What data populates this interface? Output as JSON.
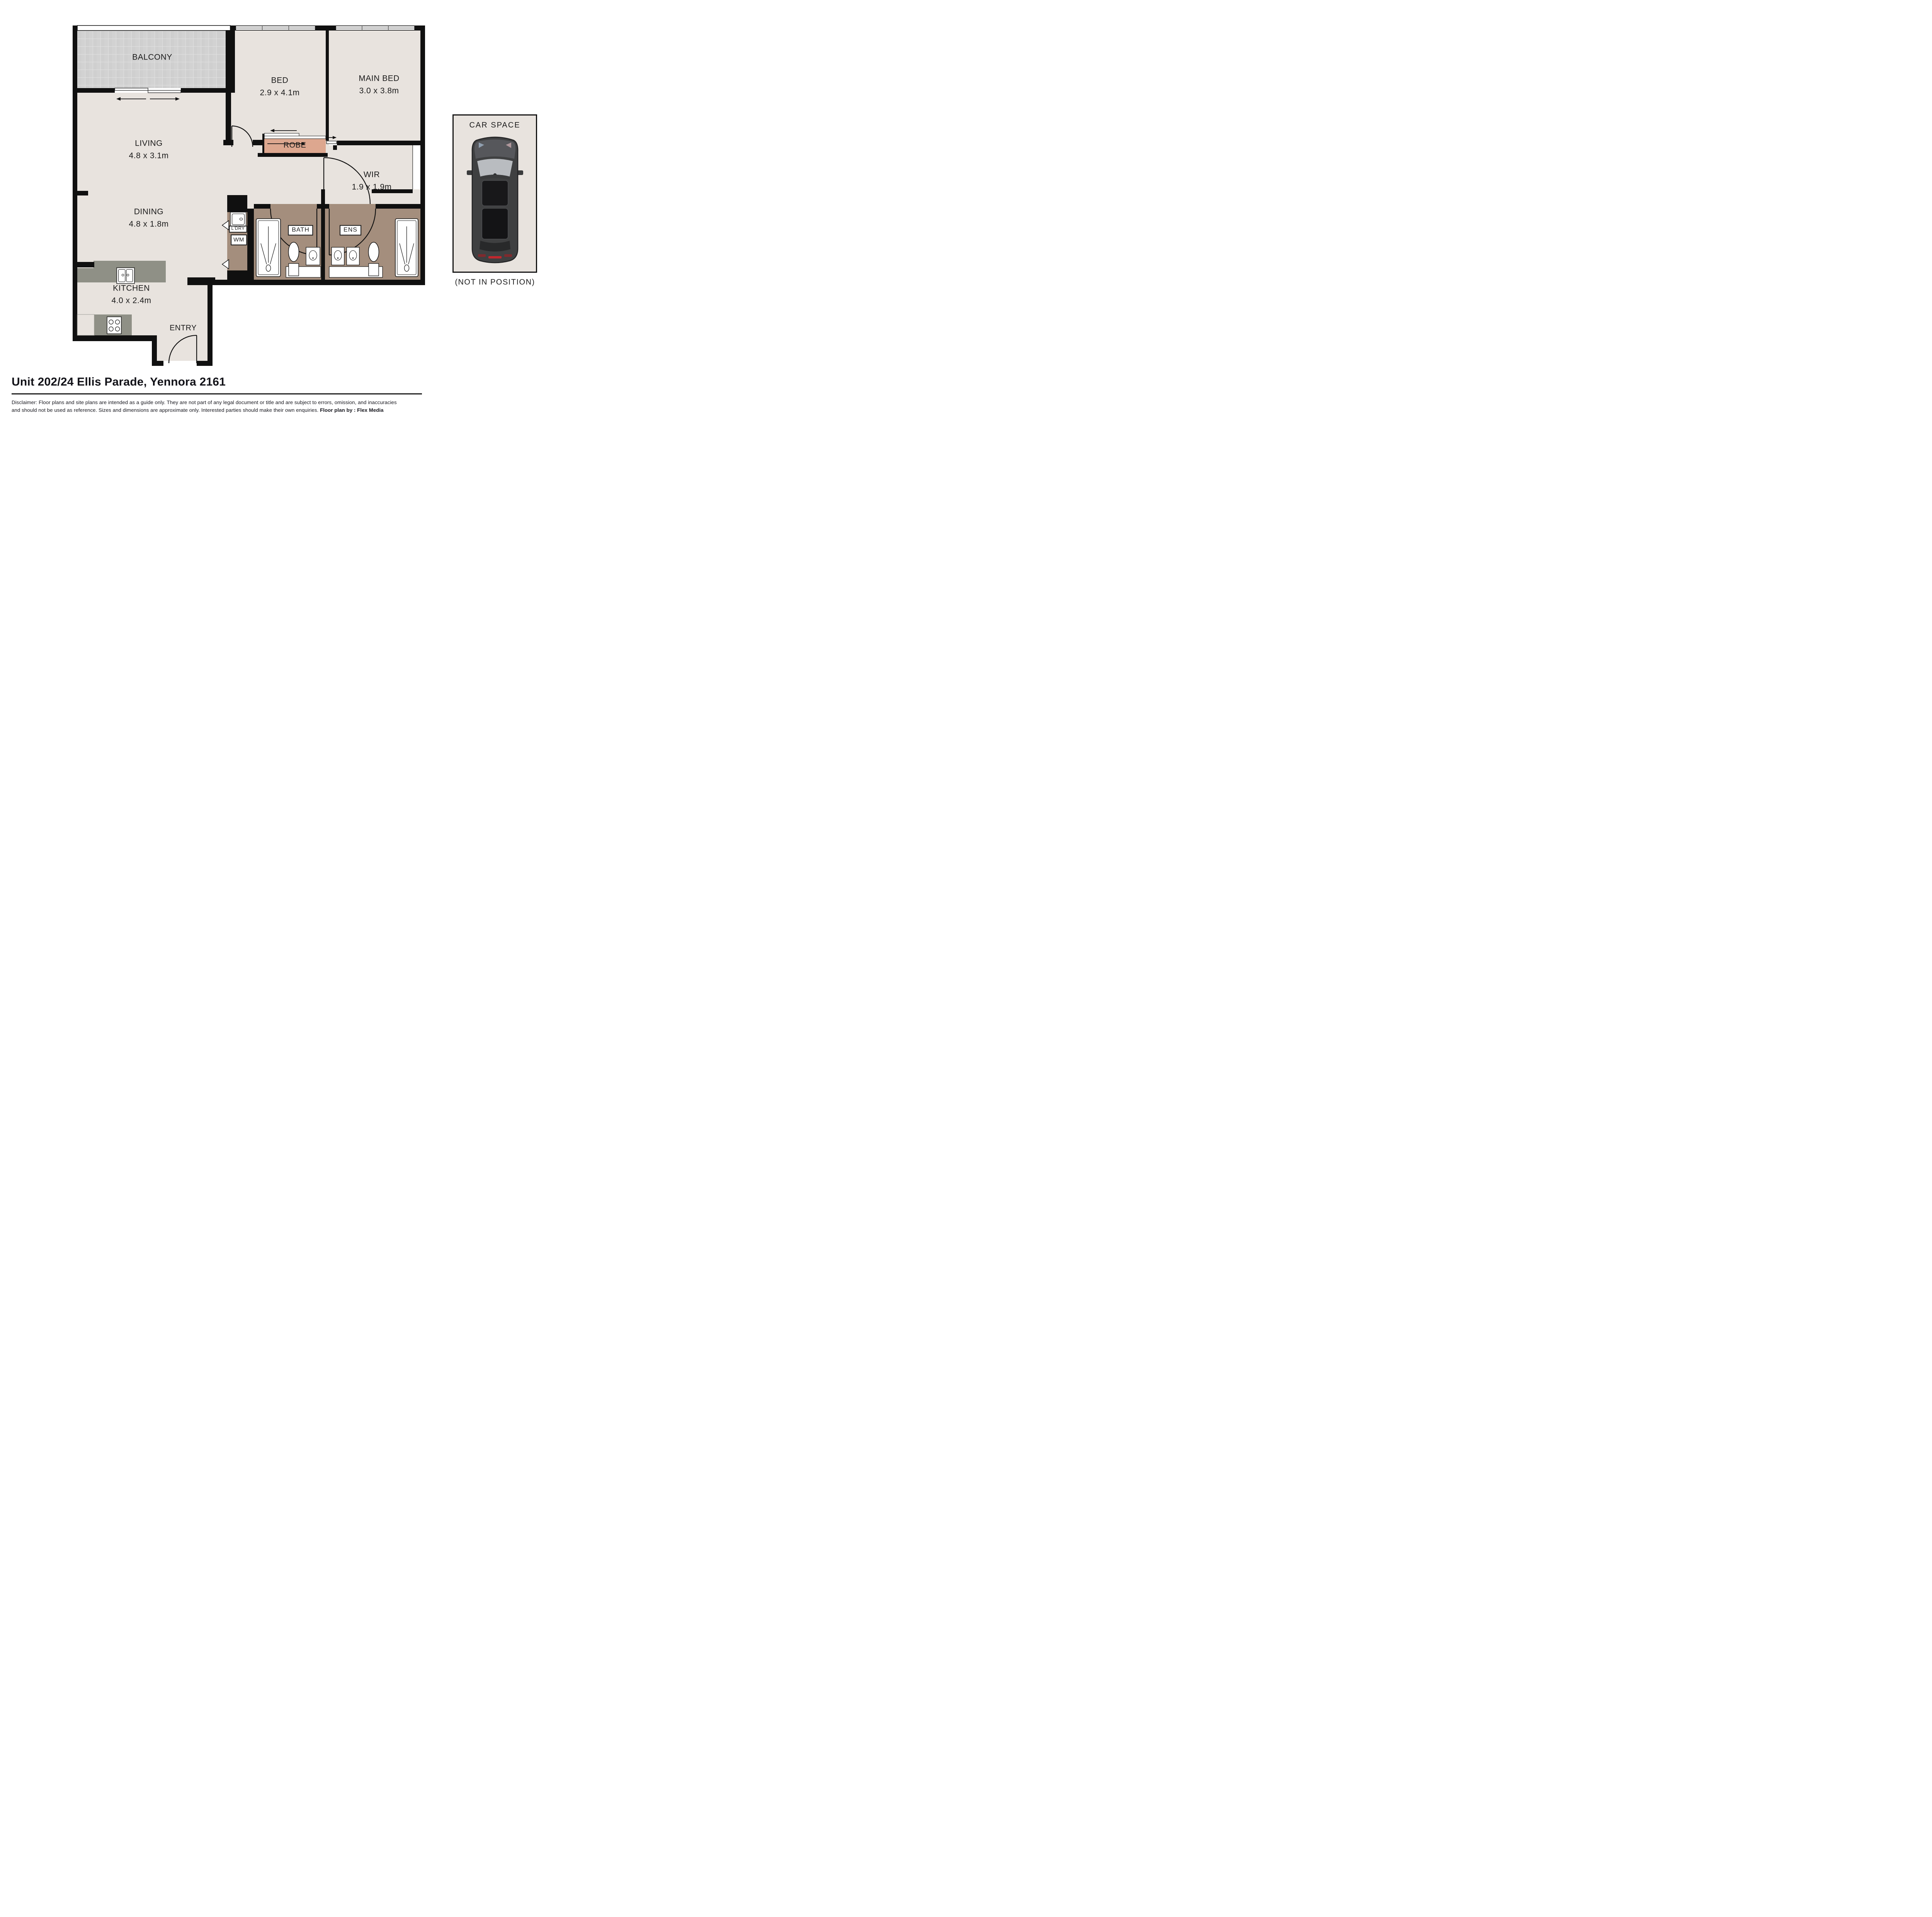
{
  "floor_plan": {
    "rooms": {
      "balcony": {
        "name": "BALCONY"
      },
      "bed": {
        "name": "BED",
        "dims": "2.9 x 4.1m"
      },
      "main_bed": {
        "name": "MAIN BED",
        "dims": "3.0 x 3.8m"
      },
      "living": {
        "name": "LIVING",
        "dims": "4.8 x 3.1m"
      },
      "dining": {
        "name": "DINING",
        "dims": "4.8 x 1.8m"
      },
      "kitchen": {
        "name": "KITCHEN",
        "dims": "4.0 x 2.4m"
      },
      "wir": {
        "name": "WIR",
        "dims": "1.9 x 1.9m"
      },
      "robe": {
        "name": "ROBE"
      },
      "bath": {
        "name": "BATH"
      },
      "ens": {
        "name": "ENS"
      },
      "laundry": {
        "name": "L’DRY"
      },
      "washing_machine": {
        "name": "WM"
      },
      "entry": {
        "name": "ENTRY"
      }
    },
    "icons": {
      "shower": "shower-spray-symbol",
      "toilet": "toilet-top-view",
      "basin": "vanity-basin",
      "sink": "double-sink",
      "stove": "four-burner-cooktop",
      "sliding_door": "double-headed-arrows"
    }
  },
  "car_space": {
    "title": "CAR SPACE",
    "note": "(NOT IN POSITION)"
  },
  "footer": {
    "address": "Unit 202/24 Ellis Parade, Yennora 2161",
    "disclaimer_line1": "Disclaimer: Floor plans and site plans are intended as a guide only. They are not part of any legal document or title and are subject to errors, omission, and inaccuracies",
    "disclaimer_line2": "and should not be used as reference. Sizes and dimensions are approximate only. Interested parties should make their own enquiries.",
    "credit": "Floor plan by : Flex Media"
  },
  "colors": {
    "floor": "#e8e3de",
    "wall": "#101010",
    "wet": "#a48e7d",
    "robe": "#dda78f",
    "tile": "#d2d2d2",
    "tileline": "#e2e2e2",
    "counter": "#8f9086",
    "page": "#ffffff"
  }
}
